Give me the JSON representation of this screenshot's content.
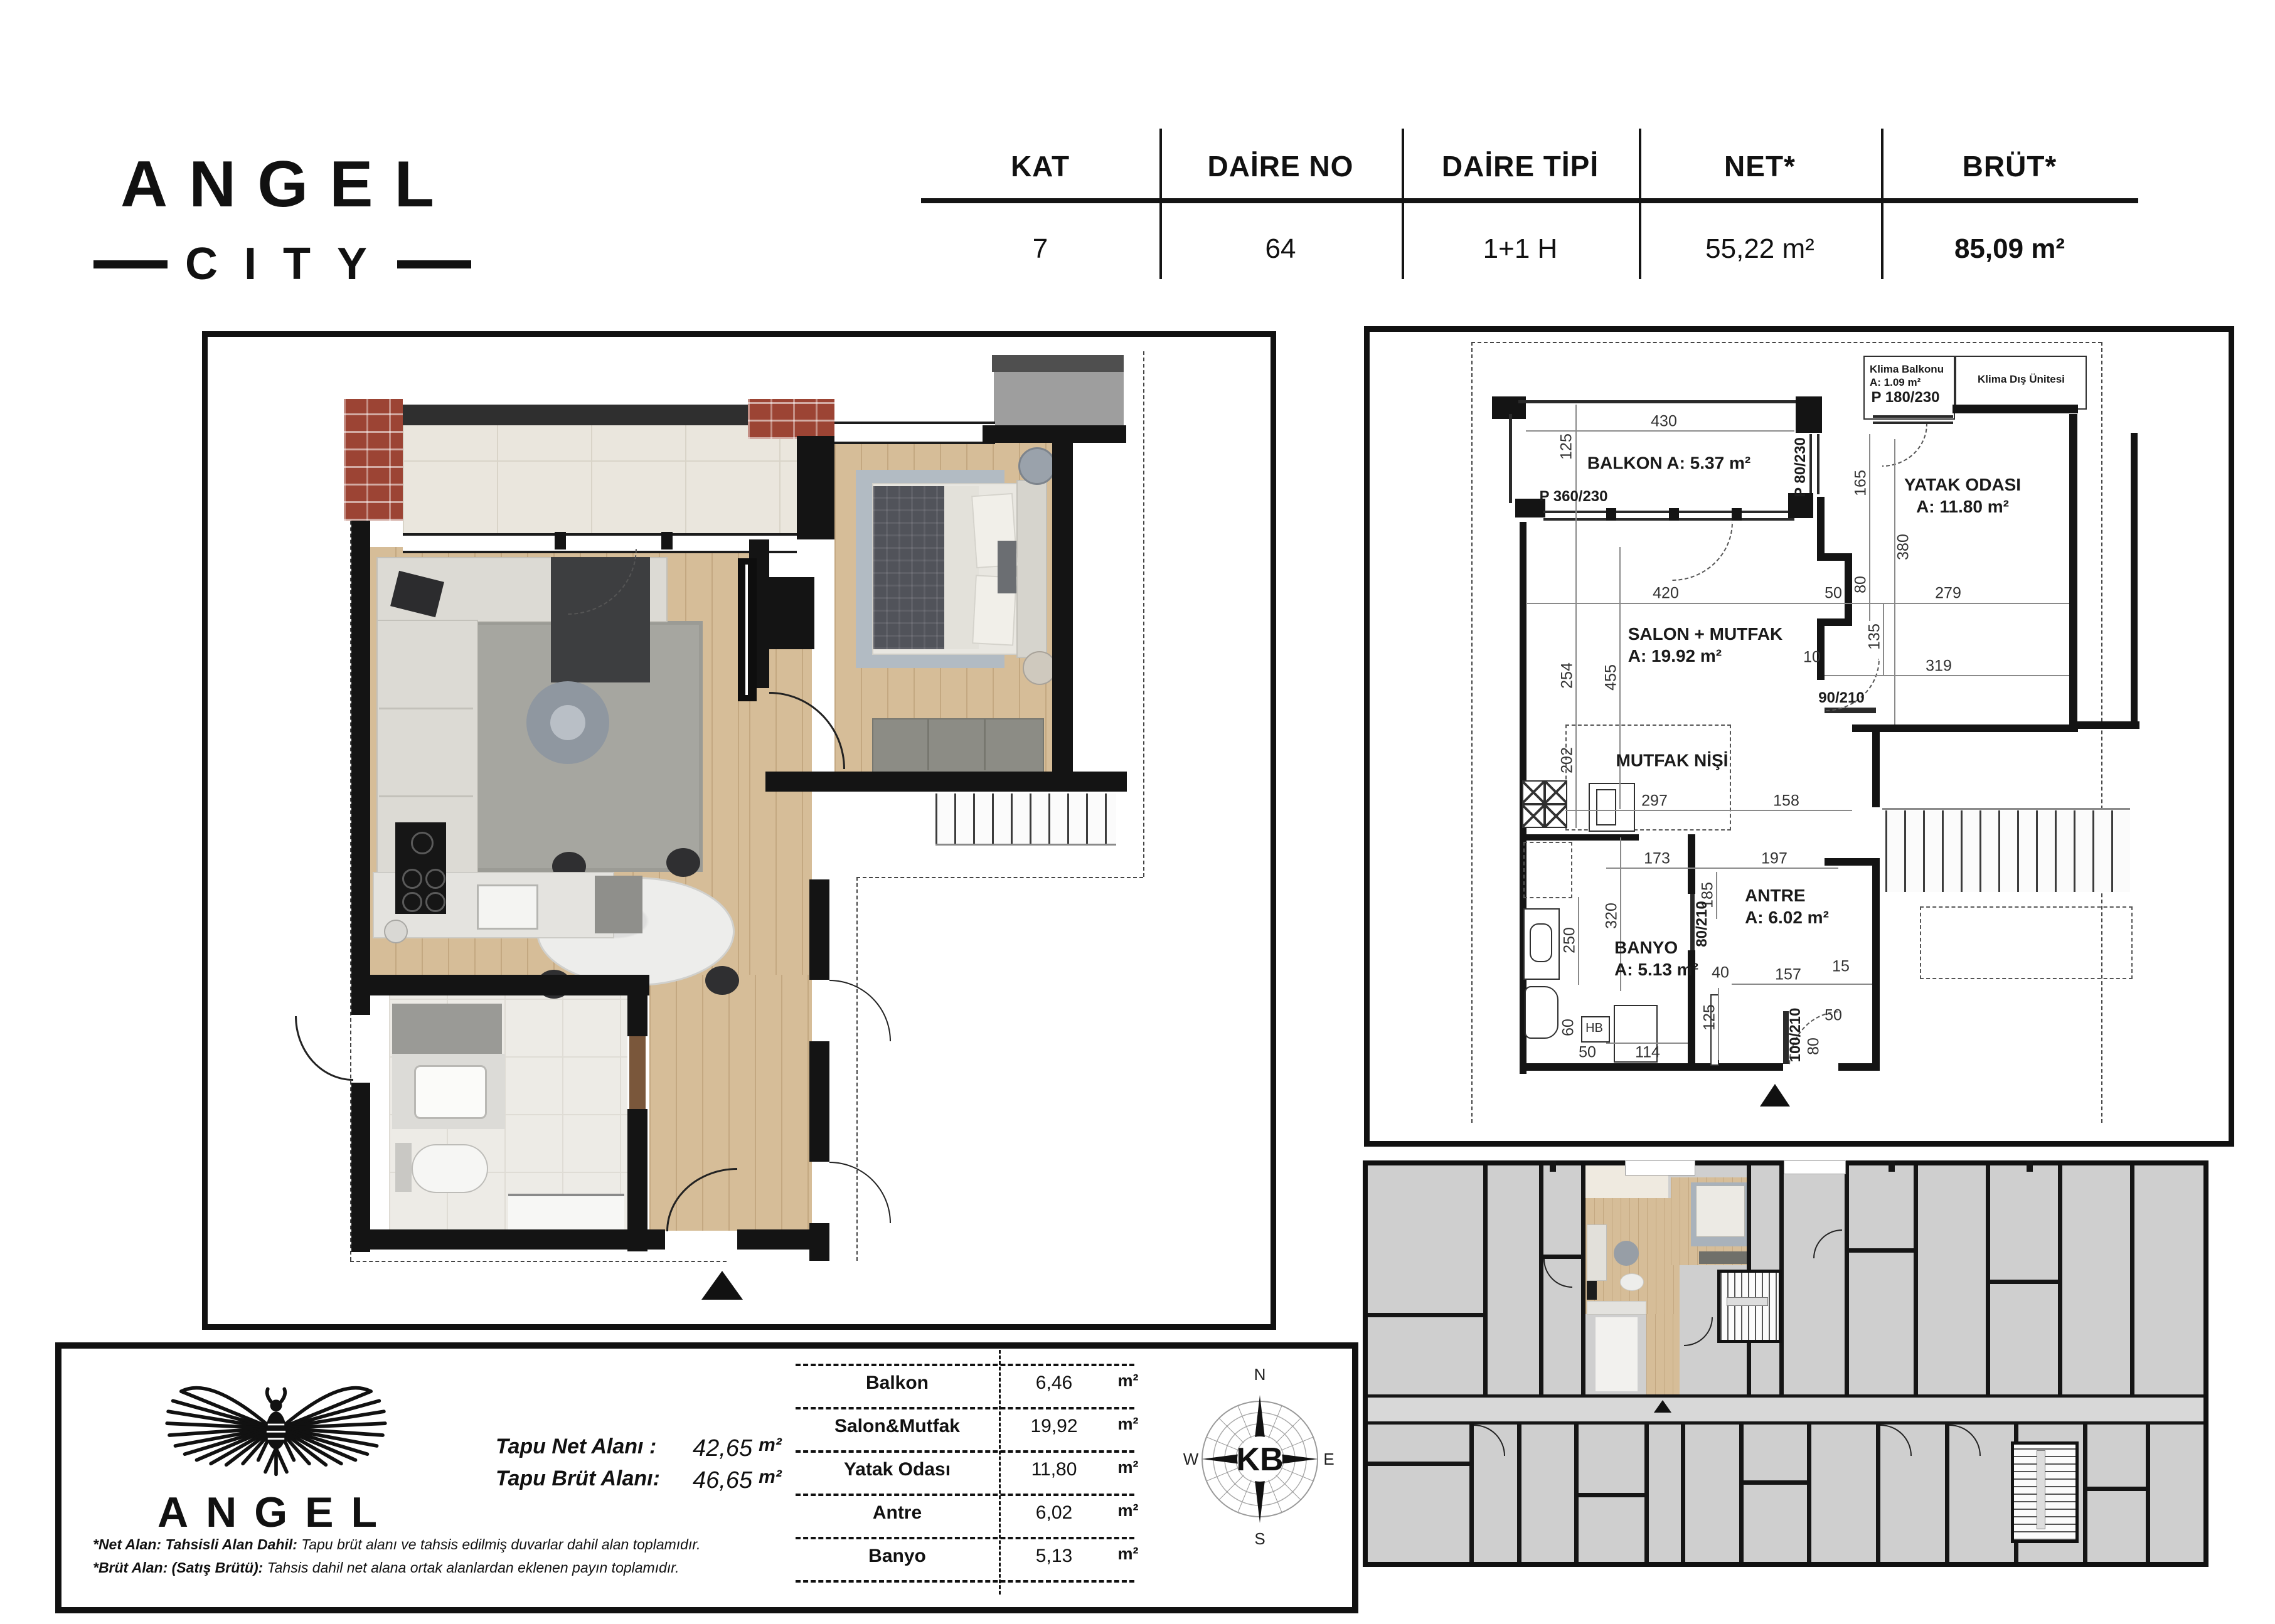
{
  "brand": {
    "logo_line1": "ANGEL",
    "logo_line2": "CITY"
  },
  "header": {
    "columns": [
      {
        "label": "KAT",
        "value": "7"
      },
      {
        "label": "DAİRE NO",
        "value": "64"
      },
      {
        "label": "DAİRE TİPİ",
        "value": "1+1 H"
      },
      {
        "label": "NET*",
        "value": "55,22 m²"
      },
      {
        "label": "BRÜT*",
        "value": "85,09 m²"
      }
    ]
  },
  "tech": {
    "rooms": [
      {
        "name": "BALKON A: 5.37 m²"
      },
      {
        "name": "YATAK ODASI",
        "area": "A: 11.80 m²"
      },
      {
        "name": "SALON + MUTFAK",
        "area": "A: 19.92 m²"
      },
      {
        "name": "MUTFAK NİŞİ"
      },
      {
        "name": "ANTRE",
        "area": "A: 6.02 m²"
      },
      {
        "name": "BANYO",
        "area": "A: 5.13 m²"
      },
      {
        "name": "Klima Balkonu",
        "area": "A: 1.09 m²"
      },
      {
        "name": "Klima Dış Ünitesi"
      }
    ],
    "doors": [
      "P 360/230",
      "P 80/230",
      "P 180/230",
      "90/210",
      "80/210",
      "100/210"
    ],
    "dims": [
      "430",
      "125",
      "165",
      "380",
      "420",
      "50",
      "80",
      "279",
      "10",
      "135",
      "319",
      "254",
      "455",
      "202",
      "297",
      "158",
      "173",
      "197",
      "185",
      "320",
      "250",
      "157",
      "15",
      "40",
      "125",
      "50",
      "80",
      "60",
      "50",
      "114",
      "HB"
    ]
  },
  "summary": {
    "logo_text": "ANGEL",
    "tapu": [
      {
        "label": "Tapu Net Alanı :",
        "value": "42,65",
        "unit": "m²"
      },
      {
        "label": "Tapu Brüt Alanı:",
        "value": "46,65",
        "unit": "m²"
      }
    ],
    "areas": {
      "rows": [
        {
          "name": "Balkon",
          "value": "6,46",
          "unit": "m²"
        },
        {
          "name": "Salon&Mutfak",
          "value": "19,92",
          "unit": "m²"
        },
        {
          "name": "Yatak Odası",
          "value": "11,80",
          "unit": "m²"
        },
        {
          "name": "Antre",
          "value": "6,02",
          "unit": "m²"
        },
        {
          "name": "Banyo",
          "value": "5,13",
          "unit": "m²"
        }
      ]
    },
    "footnotes": [
      {
        "lead": "*Net Alan: Tahsisli Alan Dahil:",
        "text": " Tapu brüt alanı ve tahsis edilmiş duvarlar dahil alan toplamıdır."
      },
      {
        "lead": "*Brüt Alan: (Satış Brütü):",
        "text": " Tahsis dahil net alana ortak alanlardan eklenen payın toplamıdır."
      }
    ]
  },
  "compass": {
    "n": "N",
    "e": "E",
    "s": "S",
    "w": "W",
    "center": "KB"
  }
}
